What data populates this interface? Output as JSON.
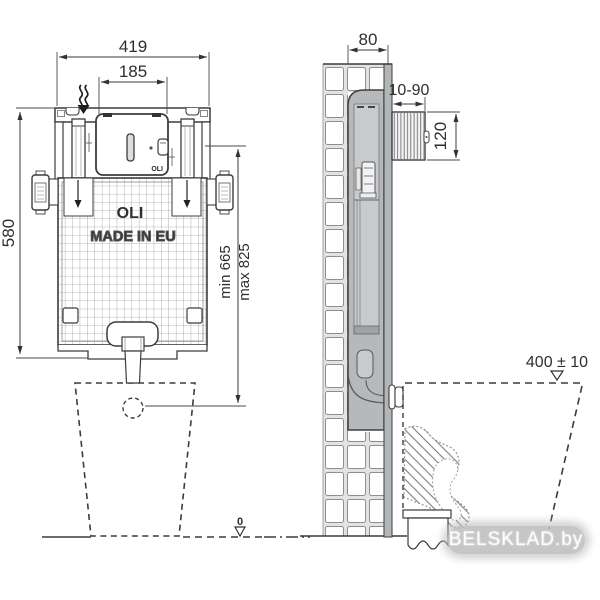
{
  "diagram": {
    "front_view": {
      "dim_overall_width": "419",
      "dim_inspection_panel_width": "185",
      "dim_tank_height": "580",
      "dim_outlet_min": "min 665",
      "dim_outlet_max": "max 825",
      "floor_datum": "0",
      "tank_logo": "OLI",
      "tank_origin_text": "MADE IN EU",
      "panel_logo": "OLI"
    },
    "side_view": {
      "dim_tank_depth": "80",
      "dim_plate_depth_range": "10-90",
      "dim_plate_height": "120",
      "dim_bowl_rim_height": "400 ± 10"
    },
    "watermark_text": "BELSKLAD.by",
    "colors": {
      "line": "#3a3a3a",
      "tank_gray": "#b5b9bb",
      "inner_gray": "#c8cbcd",
      "wall_gap_gray": "#e2e4e4",
      "watermark_bg": "#bcbcbc",
      "watermark_fg": "#ffffff"
    }
  }
}
